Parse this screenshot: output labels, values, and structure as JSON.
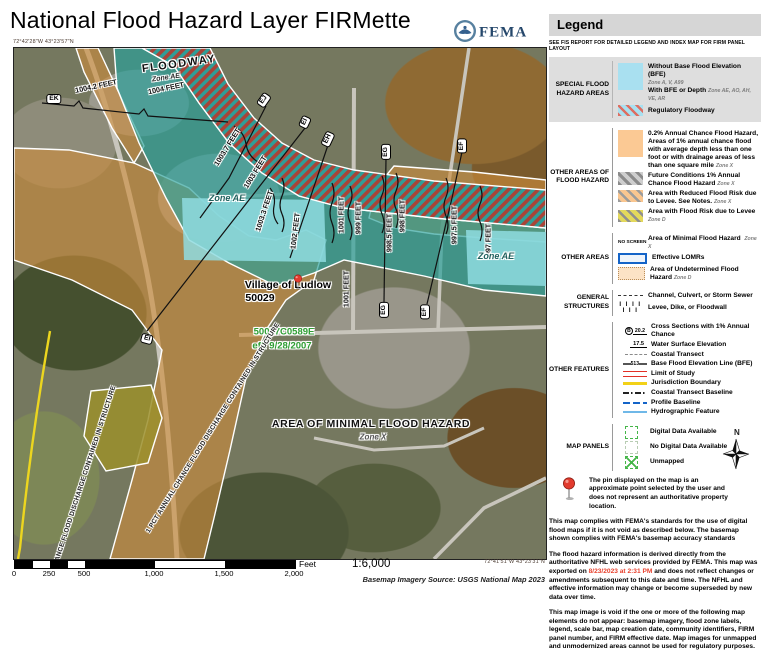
{
  "header": {
    "title": "National Flood Hazard Layer FIRMette",
    "logo_text": "FEMA"
  },
  "map": {
    "coord_top_left": "72°42'28\"W 43°23'57\"N",
    "coord_bottom_right": "72°41'51\"W 43°23'31\"N",
    "labels": [
      {
        "t": "FLOODWAY",
        "x": 165,
        "y": 16,
        "r": -8,
        "c": "big"
      },
      {
        "t": "Zone AE",
        "x": 152,
        "y": 30,
        "r": -8,
        "c": "zsm"
      },
      {
        "t": "1004.2 FEET",
        "x": 82,
        "y": 38,
        "r": -12,
        "c": "bfe"
      },
      {
        "t": "1004 FEET",
        "x": 152,
        "y": 40,
        "r": -12,
        "c": "bfe"
      },
      {
        "t": "EK",
        "x": 40,
        "y": 51,
        "r": 0,
        "c": "xs"
      },
      {
        "t": "EJ",
        "x": 250,
        "y": 52,
        "r": -55,
        "c": "xs"
      },
      {
        "t": "1003.7 FEET",
        "x": 213,
        "y": 99,
        "r": -58,
        "c": "bfe"
      },
      {
        "t": "1003 FEET",
        "x": 241,
        "y": 124,
        "r": -58,
        "c": "bfe"
      },
      {
        "t": "Zone AE",
        "x": 213,
        "y": 150,
        "r": 0,
        "c": "zone"
      },
      {
        "t": "1003.3 FEET",
        "x": 250,
        "y": 163,
        "r": -72,
        "c": "bfe"
      },
      {
        "t": "EI",
        "x": 291,
        "y": 74,
        "r": -65,
        "c": "xs"
      },
      {
        "t": "EH",
        "x": 314,
        "y": 91,
        "r": -65,
        "c": "xs"
      },
      {
        "t": "1002 FEET",
        "x": 281,
        "y": 183,
        "r": -83,
        "c": "bfe"
      },
      {
        "t": "1001 FEET",
        "x": 327,
        "y": 167,
        "r": -90,
        "c": "bfe"
      },
      {
        "t": "999 FEET",
        "x": 344,
        "y": 170,
        "r": -90,
        "c": "bfe"
      },
      {
        "t": "EG",
        "x": 372,
        "y": 104,
        "r": -90,
        "c": "xs"
      },
      {
        "t": "998.5 FEET",
        "x": 375,
        "y": 185,
        "r": -90,
        "c": "bfe"
      },
      {
        "t": "998 FEET",
        "x": 388,
        "y": 168,
        "r": -90,
        "c": "bfe"
      },
      {
        "t": "EF",
        "x": 448,
        "y": 98,
        "r": -90,
        "c": "xs"
      },
      {
        "t": "997.5 FEET",
        "x": 440,
        "y": 177,
        "r": -90,
        "c": "bfe"
      },
      {
        "t": "997 FEET",
        "x": 474,
        "y": 192,
        "r": -90,
        "c": "bfe"
      },
      {
        "t": "Zone AE",
        "x": 482,
        "y": 208,
        "r": 0,
        "c": "zone"
      },
      {
        "t": "1001 FEET",
        "x": 332,
        "y": 241,
        "r": -90,
        "c": "bfe"
      },
      {
        "t": "EG",
        "x": 370,
        "y": 262,
        "r": -90,
        "c": "xs"
      },
      {
        "t": "EF",
        "x": 411,
        "y": 264,
        "r": -90,
        "c": "xs"
      },
      {
        "t": "EI",
        "x": 133,
        "y": 291,
        "r": 15,
        "c": "xs"
      },
      {
        "t": "Village of Ludlow",
        "x": 274,
        "y": 237,
        "r": 0,
        "c": "community"
      },
      {
        "t": "50029",
        "x": 246,
        "y": 250,
        "r": 0,
        "c": "community"
      },
      {
        "t": "50027C0589E",
        "x": 270,
        "y": 284,
        "r": 0,
        "c": "panelid"
      },
      {
        "t": "eff. 9/28/2007",
        "x": 268,
        "y": 298,
        "r": 0,
        "c": "panelid"
      },
      {
        "t": "1 PCT ANNUAL CHANCE FLOOD DISCHARGE CONTAINED IN STRUCTURE",
        "x": 199,
        "y": 380,
        "r": -58,
        "c": "corridor"
      },
      {
        "t": "1 PCT ANNUAL CHANCE FLOOD DISCHARGE CONTAINED IN STRUCTURE",
        "x": 62,
        "y": 455,
        "r": -72,
        "c": "corridor"
      },
      {
        "t": "AREA OF MINIMAL FLOOD HAZARD",
        "x": 357,
        "y": 376,
        "r": 0,
        "c": "big2"
      },
      {
        "t": "Zone X",
        "x": 359,
        "y": 389,
        "r": 0,
        "c": "zonex"
      }
    ],
    "pin": {
      "x": 284,
      "y": 241
    }
  },
  "scale": {
    "ticks": [
      "0",
      "250",
      "500",
      "1,000",
      "1,500",
      "2,000"
    ],
    "tick_x": [
      0,
      35,
      70,
      140,
      210,
      280
    ],
    "unit": "Feet",
    "ratio": "1:6,000",
    "source": "Basemap Imagery Source: USGS National Map 2023"
  },
  "legend": {
    "title": "Legend",
    "subtitle": "SEE FIS REPORT FOR DETAILED LEGEND AND INDEX MAP FOR FIRM PANEL LAYOUT",
    "sfha": {
      "label": "SPECIAL FLOOD HAZARD AREAS",
      "row1_title": "Without Base Flood Elevation (BFE)",
      "row1_zone": "Zone A, V, A99",
      "row2_title": "With BFE or Depth",
      "row2_zone": "Zone AE, AO, AH, VE, AR",
      "row3_title": "Regulatory Floodway"
    },
    "other_flood": {
      "label": "OTHER AREAS OF FLOOD HAZARD",
      "row1_title": "0.2% Annual Chance Flood Hazard, Areas of 1% annual chance flood with average depth less than one foot or with drainage areas of less than one square mile",
      "row1_zone": "Zone X",
      "row2_title": "Future Conditions 1% Annual Chance Flood Hazard",
      "row2_zone": "Zone X",
      "row3_title": "Area with Reduced Flood Risk due to Levee. See Notes.",
      "row3_zone": "Zone X",
      "row4_title": "Area with Flood Risk due to Levee",
      "row4_zone": "Zone D"
    },
    "other_areas": {
      "label": "OTHER AREAS",
      "row1_swatch": "NO SCREEN",
      "row1_title": "Area of Minimal Flood Hazard",
      "row1_zone": "Zone X",
      "row2_title": "Effective LOMRs",
      "row3_title": "Area of Undetermined Flood Hazard",
      "row3_zone": "Zone D"
    },
    "structures": {
      "label": "GENERAL STRUCTURES",
      "row1_title": "Channel, Culvert, or Storm Sewer",
      "row2_title": "Levee, Dike, or Floodwall",
      "levee_ticks": "I I I I I I I"
    },
    "other_features": {
      "label": "OTHER FEATURES",
      "xs_letter": "B",
      "rows": [
        {
          "value": "20.2",
          "title": "Cross Sections with 1% Annual Chance"
        },
        {
          "value": "17.5",
          "title": "Water Surface Elevation"
        },
        {
          "value": "",
          "title": "Coastal Transect"
        },
        {
          "value": "513",
          "title": "Base Flood Elevation Line (BFE)"
        },
        {
          "value": "",
          "title": "Limit of Study"
        },
        {
          "value": "",
          "title": "Jurisdiction Boundary"
        },
        {
          "value": "",
          "title": "Coastal Transect Baseline"
        },
        {
          "value": "",
          "title": "Profile Baseline"
        },
        {
          "value": "",
          "title": "Hydrographic Feature"
        }
      ]
    },
    "map_panels": {
      "label": "MAP PANELS",
      "row1_title": "Digital Data Available",
      "row2_title": "No Digital Data Available",
      "row3_title": "Unmapped",
      "north_label": "N"
    },
    "pin_note": "The pin displayed on the map is an approximate point selected by the user and does not represent an authoritative property location."
  },
  "notes": {
    "para1": "This map complies with FEMA's standards for the use of digital flood maps if it is not void as described below. The basemap shown complies with FEMA's basemap accuracy standards",
    "para2_before": "The flood hazard information is derived directly from the authoritative NFHL web services provided by FEMA. This map was exported on ",
    "para2_date": "8/23/2023 at 2:31 PM",
    "para2_after": " and does not reflect changes or amendments subsequent to this date and time. The NFHL and effective information may change or become superseded by new data over time.",
    "para3": "This map image is void if the one or more of the following map elements do not appear: basemap imagery, flood zone labels, legend, scale bar, map creation date, community identifiers, FIRM panel number, and FIRM effective date. Map images for unmapped and unmodernized areas cannot be used for regulatory purposes."
  },
  "colors": {
    "sfha_fill": "#a9e0f0",
    "floodway_red": "#a84438",
    "flood_02pct_orange": "#fbc994",
    "lomr_blue": "#1464c8",
    "limit_of_study_red": "#e23026",
    "jurisdiction_yellow": "#f2d117",
    "panel_green": "#45b649",
    "export_date_red": "#e8402c",
    "firm_panel_text_green": "#2e9e33"
  }
}
